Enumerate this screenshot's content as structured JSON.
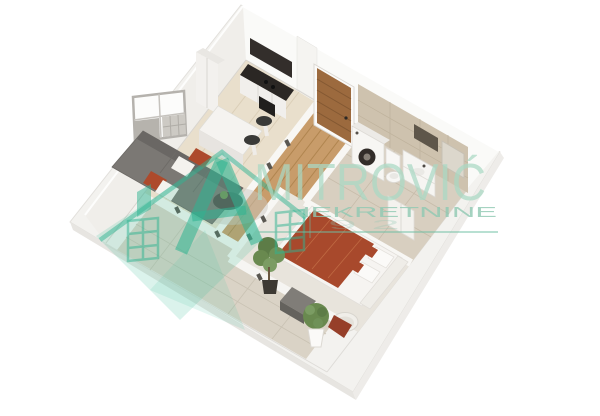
{
  "watermark": {
    "brand_name": "MITROVIĆ",
    "brand_subtitle": "NEKRETNINE",
    "partial_digits": "9 2",
    "brand_color": "#2fb492"
  },
  "scene": {
    "type": "3d-apartment-floor-plan-render",
    "background_color": "#ffffff",
    "rooms": [
      "kitchen",
      "living-room",
      "hallway",
      "bathroom",
      "bedroom",
      "terrace"
    ],
    "furniture": [
      "kitchen-counter",
      "kitchen-island",
      "bar-stools",
      "sofa",
      "coffee-table",
      "window",
      "entrance-door",
      "washing-machine",
      "toilet",
      "vanity-sink",
      "mirror",
      "double-bed",
      "wardrobe",
      "terrace-table",
      "barrel-chair",
      "potted-plants"
    ],
    "colors": {
      "wall": "#f3f2ef",
      "floor_light_wood": "#e9dfcc",
      "floor_oak": "#c89c6a",
      "tile_beige": "#d8cfc0",
      "counter_dark": "#2b2724",
      "sofa_grey": "#7b7874",
      "accent_terracotta": "#a8492c",
      "door_wood": "#9c6a3e",
      "plant_green": "#69894f"
    }
  }
}
